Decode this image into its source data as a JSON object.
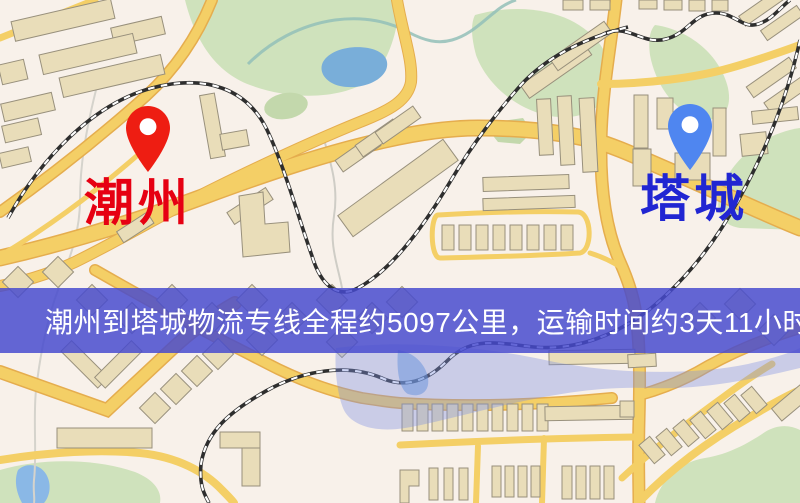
{
  "map": {
    "markers": [
      {
        "id": "origin",
        "label": "潮州",
        "pin_color": "#ee1d12",
        "label_color": "#e60012"
      },
      {
        "id": "destination",
        "label": "塔城",
        "pin_color": "#4f86f0",
        "label_color": "#2126d2"
      }
    ],
    "palette": {
      "background": "#f8f1ea",
      "road_fill": "#f4cf66",
      "road_casing": "#e5ad4e",
      "building_fill": "#e9ddb9",
      "building_stroke": "#98907c",
      "park_green": "#cfe2bc",
      "water_blue": "#79aed9",
      "railway_black": "#2e2e2e"
    }
  },
  "banner": {
    "text": "潮州到塔城物流专线全程约5097公里，运输时间约3天11小时.",
    "background_color": "#464ace",
    "text_color": "#ffffff"
  }
}
